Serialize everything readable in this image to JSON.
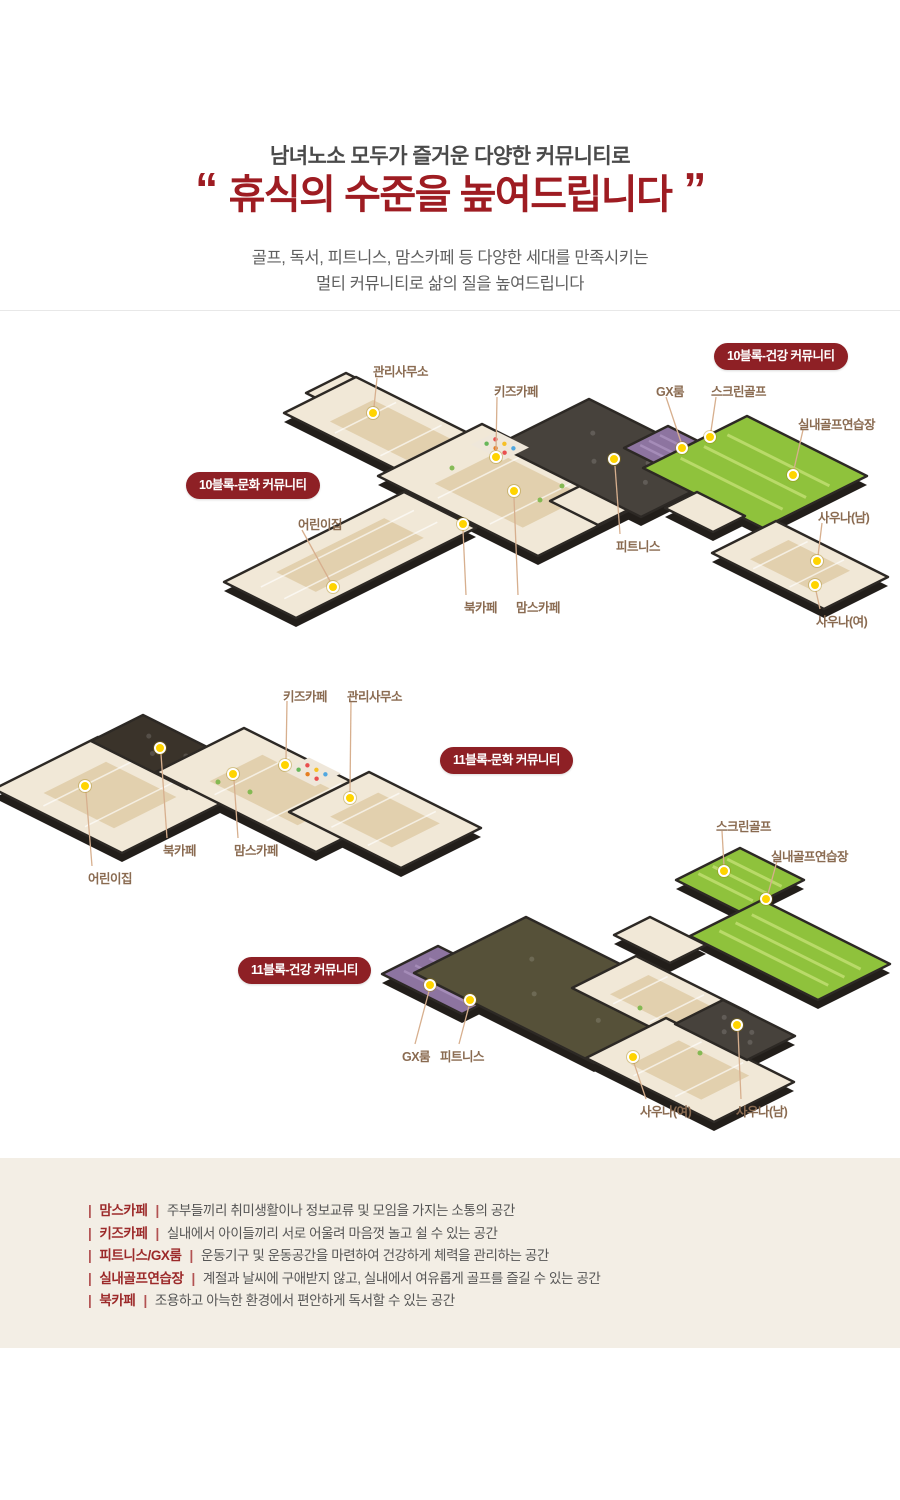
{
  "header": {
    "eyebrow": "남녀노소 모두가 즐거운 다양한 커뮤니티로",
    "quote_open": "“",
    "title": "휴식의 수준을 높여드립니다",
    "quote_close": "”",
    "desc_line1": "골프, 독서, 피트니스, 맘스카페 등 다양한 세대를 만족시키는",
    "desc_line2": "멀티 커뮤니티로 삶의 질을 높여드립니다"
  },
  "plans": [
    {
      "id": "block10",
      "badges": [
        {
          "name": "badge-10block-health",
          "label": "10블록-건강 커뮤니티",
          "x": 714,
          "y": 343
        },
        {
          "name": "badge-10block-culture",
          "label": "10블록-문화 커뮤니티",
          "x": 186,
          "y": 472
        }
      ],
      "callouts": [
        {
          "label": "관리사무소",
          "lx": 373,
          "ly": 361,
          "dot": [
            373,
            413
          ],
          "line": [
            [
              377,
              378
            ],
            [
              374,
              407
            ]
          ]
        },
        {
          "label": "키즈카페",
          "lx": 494,
          "ly": 381,
          "dot": [
            496,
            457
          ],
          "line": [
            [
              497,
              397
            ],
            [
              496,
              451
            ]
          ]
        },
        {
          "label": "GX룸",
          "lx": 656,
          "ly": 381,
          "dot": [
            682,
            448
          ],
          "line": [
            [
              666,
              397
            ],
            [
              681,
              442
            ]
          ]
        },
        {
          "label": "스크린골프",
          "lx": 711,
          "ly": 381,
          "dot": [
            710,
            437
          ],
          "line": [
            [
              716,
              397
            ],
            [
              711,
              431
            ]
          ]
        },
        {
          "label": "실내골프연습장",
          "lx": 798,
          "ly": 414,
          "dot": [
            793,
            475
          ],
          "line": [
            [
              803,
              430
            ],
            [
              794,
              469
            ]
          ]
        },
        {
          "label": "피트니스",
          "lx": 616,
          "ly": 536,
          "dot": [
            614,
            459
          ],
          "line": [
            [
              620,
              534
            ],
            [
              615,
              466
            ]
          ]
        },
        {
          "label": "북카페",
          "lx": 464,
          "ly": 597,
          "dot": [
            463,
            524
          ],
          "line": [
            [
              466,
              595
            ],
            [
              463,
              530
            ]
          ]
        },
        {
          "label": "맘스카페",
          "lx": 516,
          "ly": 597,
          "dot": [
            514,
            491
          ],
          "line": [
            [
              518,
              595
            ],
            [
              514,
              498
            ]
          ]
        },
        {
          "label": "어린이집",
          "lx": 298,
          "ly": 514,
          "dot": [
            333,
            587
          ],
          "line": [
            [
              302,
              530
            ],
            [
              330,
              581
            ]
          ]
        },
        {
          "label": "사우나(남)",
          "lx": 818,
          "ly": 507,
          "dot": [
            817,
            561
          ],
          "line": [
            [
              822,
              523
            ],
            [
              818,
              556
            ]
          ]
        },
        {
          "label": "사우나(여)",
          "lx": 816,
          "ly": 611,
          "dot": [
            815,
            585
          ],
          "line": [
            [
              820,
              609
            ],
            [
              816,
              591
            ]
          ]
        }
      ]
    },
    {
      "id": "block11-culture",
      "badges": [
        {
          "name": "badge-11block-culture",
          "label": "11블록-문화 커뮤니티",
          "x": 440,
          "y": 747
        }
      ],
      "callouts": [
        {
          "label": "키즈카페",
          "lx": 283,
          "ly": 686,
          "dot": [
            285,
            765
          ],
          "line": [
            [
              287,
              701
            ],
            [
              286,
              759
            ]
          ]
        },
        {
          "label": "관리사무소",
          "lx": 347,
          "ly": 686,
          "dot": [
            350,
            798
          ],
          "line": [
            [
              351,
              701
            ],
            [
              350,
              792
            ]
          ]
        },
        {
          "label": "북카페",
          "lx": 163,
          "ly": 840,
          "dot": [
            160,
            748
          ],
          "line": [
            [
              167,
              838
            ],
            [
              161,
              754
            ]
          ]
        },
        {
          "label": "맘스카페",
          "lx": 234,
          "ly": 840,
          "dot": [
            233,
            774
          ],
          "line": [
            [
              238,
              838
            ],
            [
              234,
              780
            ]
          ]
        },
        {
          "label": "어린이집",
          "lx": 88,
          "ly": 868,
          "dot": [
            85,
            786
          ],
          "line": [
            [
              92,
              866
            ],
            [
              86,
              792
            ]
          ]
        }
      ]
    },
    {
      "id": "block11-health",
      "badges": [
        {
          "name": "badge-11block-health",
          "label": "11블록-건강 커뮤니티",
          "x": 238,
          "y": 957
        }
      ],
      "callouts": [
        {
          "label": "스크린골프",
          "lx": 716,
          "ly": 816,
          "dot": [
            724,
            871
          ],
          "line": [
            [
              722,
              831
            ],
            [
              724,
              866
            ]
          ]
        },
        {
          "label": "실내골프연습장",
          "lx": 771,
          "ly": 846,
          "dot": [
            766,
            899
          ],
          "line": [
            [
              777,
              861
            ],
            [
              768,
              894
            ]
          ]
        },
        {
          "label": "GX룸",
          "lx": 402,
          "ly": 1046,
          "dot": [
            430,
            985
          ],
          "line": [
            [
              415,
              1044
            ],
            [
              429,
              991
            ]
          ]
        },
        {
          "label": "피트니스",
          "lx": 440,
          "ly": 1046,
          "dot": [
            470,
            1000
          ],
          "line": [
            [
              459,
              1044
            ],
            [
              469,
              1006
            ]
          ]
        },
        {
          "label": "사우나(여)",
          "lx": 640,
          "ly": 1101,
          "dot": [
            633,
            1057
          ],
          "line": [
            [
              646,
              1099
            ],
            [
              634,
              1063
            ]
          ]
        },
        {
          "label": "사우나(남)",
          "lx": 736,
          "ly": 1101,
          "dot": [
            737,
            1025
          ],
          "line": [
            [
              741,
              1099
            ],
            [
              738,
              1031
            ]
          ]
        }
      ]
    }
  ],
  "legend": {
    "items": [
      {
        "term": "맘스카페",
        "desc": "주부들끼리 취미생활이나 정보교류 및 모임을 가지는 소통의 공간"
      },
      {
        "term": "키즈카페",
        "desc": "실내에서 아이들끼리 서로 어울려 마음껏 놀고 쉴 수 있는 공간"
      },
      {
        "term": "피트니스/GX룸",
        "desc": "운동기구 및 운동공간을 마련하여 건강하게 체력을 관리하는 공간"
      },
      {
        "term": "실내골프연습장",
        "desc": "계절과 날씨에 구애받지 않고, 실내에서 여유롭게 골프를 즐길 수 있는 공간"
      },
      {
        "term": "북카페",
        "desc": "조용하고 아늑한 환경에서 편안하게 독서할 수 있는 공간"
      }
    ]
  },
  "colors": {
    "title_red": "#9e1c22",
    "badge_red": "#8e2025",
    "label_brown": "#8a6b51",
    "leader_tan": "#d7af8e",
    "dot_yellow": "#ffd400",
    "legend_bg": "#f3eee5"
  }
}
